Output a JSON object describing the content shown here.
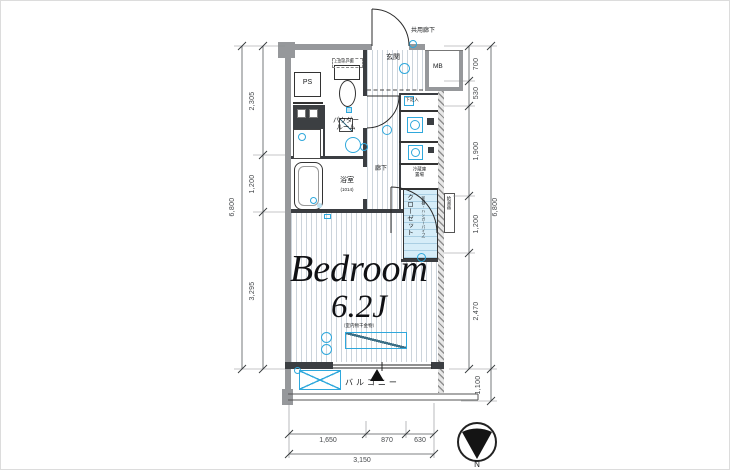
{
  "rooms": {
    "bedroom": {
      "label": "Bedroom",
      "size": "6.2J",
      "note": "（室内物干金物）"
    },
    "balcony": {
      "label": "バルコニー"
    },
    "entrance": {
      "label": "玄関"
    },
    "powder_room": {
      "line1": "パウダー",
      "line2": "ルーム"
    },
    "bathroom": {
      "label": "浴室",
      "size": "(1014)"
    },
    "hallway": {
      "label": "廊下"
    },
    "closet": {
      "label": "クローゼット",
      "note": "（枕棚・ハンガーパイプ）"
    },
    "shoe_box": {
      "label": "下足入"
    },
    "fridge": {
      "line1": "冷蔵庫",
      "line2": "置場"
    },
    "water_heater": {
      "label": "給湯器"
    },
    "upper_cabinet": {
      "label": "上部吊戸棚"
    },
    "ps": {
      "label": "PS"
    },
    "mb": {
      "label": "MB"
    },
    "common_corridor": {
      "label": "共用廊下"
    }
  },
  "dimensions": {
    "left": {
      "segments": [
        "2,305",
        "1,200",
        "3,295"
      ],
      "total": "6,800"
    },
    "right": {
      "segments": [
        "700",
        "530",
        "1,900",
        "1,200",
        "2,470"
      ],
      "total": "6,800",
      "balcony": "1,100"
    },
    "bottom": {
      "segments": [
        "1,650",
        "870",
        "630"
      ],
      "total": "3,150"
    }
  },
  "compass": {
    "north": "N"
  },
  "colors": {
    "fixture_blue": "#2fa8dc",
    "closet_fill": "#d6edf8",
    "wall_gray": "#96989b",
    "floor_hatch": "#ccd4db"
  }
}
